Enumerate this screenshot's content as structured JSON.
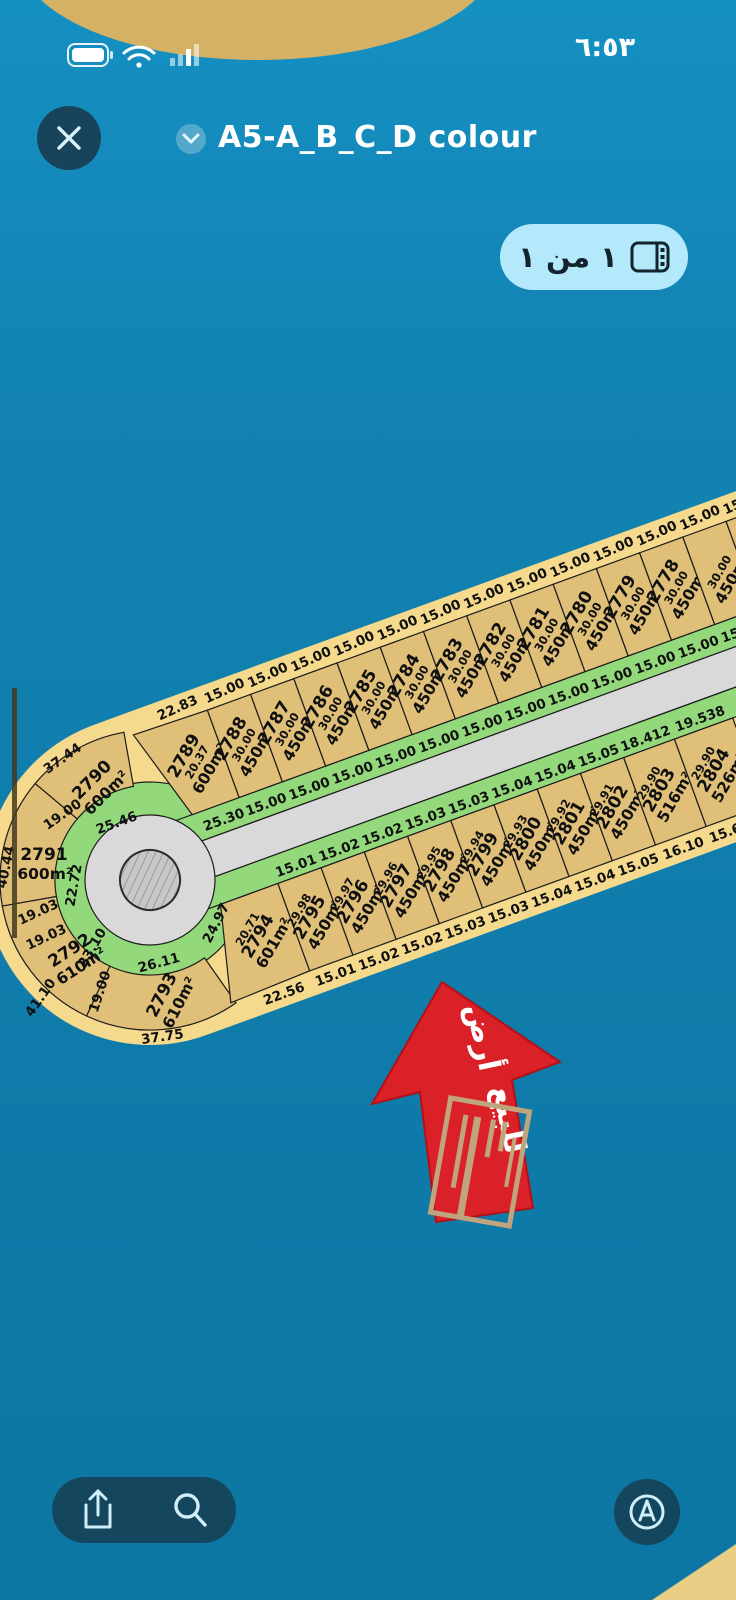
{
  "status_bar": {
    "time": "٦:٥٣",
    "battery_icon": "battery-full",
    "wifi_icon": "wifi",
    "cellular_icon": "cellular-bars"
  },
  "header": {
    "title": "A5-A_B_C_D colour"
  },
  "page_badge": {
    "label": "١ من ١"
  },
  "map": {
    "colors": {
      "sea": "#0f7cab",
      "island": "#f5da8e",
      "plot_fill": "#e0bf78",
      "green_strip": "#93d97c",
      "road": "#d9d9d9",
      "arrow_red": "#da2127",
      "line": "#1c1c1c"
    },
    "north_cells": [
      {
        "num": "2789",
        "area": "600m²",
        "side": "20.37"
      },
      {
        "num": "2788",
        "area": "450m²",
        "side": "30.00"
      },
      {
        "num": "2787",
        "area": "450m²",
        "side": "30.00"
      },
      {
        "num": "2786",
        "area": "450m²",
        "side": "30.00"
      },
      {
        "num": "2785",
        "area": "450m²",
        "side": "30.00"
      },
      {
        "num": "2784",
        "area": "450m²",
        "side": "30.00"
      },
      {
        "num": "2783",
        "area": "450m²",
        "side": "30.00"
      },
      {
        "num": "2782",
        "area": "450m²",
        "side": "30.00"
      },
      {
        "num": "2781",
        "area": "450m²",
        "side": "30.00"
      },
      {
        "num": "2780",
        "area": "450m²",
        "side": "30.00"
      },
      {
        "num": "2779",
        "area": "450m²",
        "side": "30.00"
      },
      {
        "num": "2778",
        "area": "450m²",
        "side": "30.00"
      },
      {
        "num": "",
        "area": "450m²",
        "side": "30.00"
      }
    ],
    "south_cells": [
      {
        "num": "2794",
        "area": "601m²",
        "side": "20.71"
      },
      {
        "num": "2795",
        "area": "450m²",
        "side": "29.98"
      },
      {
        "num": "2796",
        "area": "450m²",
        "side": "29.97"
      },
      {
        "num": "2797",
        "area": "450m²",
        "side": "29.96"
      },
      {
        "num": "2798",
        "area": "450m²",
        "side": "29.95"
      },
      {
        "num": "2799",
        "area": "450m²",
        "side": "29.94"
      },
      {
        "num": "2800",
        "area": "450m²",
        "side": "29.93"
      },
      {
        "num": "2801",
        "area": "450m²",
        "side": "29.92"
      },
      {
        "num": "2802",
        "area": "450m²",
        "side": "29.91"
      },
      {
        "num": "2803",
        "area": "516m²",
        "side": "29.90"
      },
      {
        "num": "2804",
        "area": "526m²",
        "side": "29.90"
      }
    ],
    "bulb_plots": [
      {
        "num": "2790",
        "area": "600m²"
      },
      {
        "num": "2791",
        "area": "600m²"
      },
      {
        "num": "2792",
        "area": "610m²"
      },
      {
        "num": "2793",
        "area": "610m²"
      }
    ],
    "north_top_labels": [
      "22.83",
      "15.00",
      "15.00",
      "15.00",
      "15.00",
      "15.00",
      "15.00",
      "15.00",
      "15.00",
      "15.00",
      "15.00",
      "15.00",
      "15.00",
      "15.00"
    ],
    "north_green_labels": [
      "25.30",
      "15.00",
      "15.00",
      "15.00",
      "15.00",
      "15.00",
      "15.00",
      "15.00",
      "15.00",
      "15.00",
      "15.00",
      "15.00",
      "15.00"
    ],
    "south_green_labels": [
      "15.01",
      "15.02",
      "15.02",
      "15.03",
      "15.03",
      "15.04",
      "15.04",
      "15.05",
      "18.412",
      "19.538"
    ],
    "south_bottom_labels": [
      "22.56",
      "15.01",
      "15.02",
      "15.02",
      "15.03",
      "15.03",
      "15.04",
      "15.04",
      "15.05",
      "16.10",
      "15.645"
    ],
    "bulb_dim_labels": [
      "37.44",
      "25.46",
      "19.00",
      "40.44",
      "22.72",
      "19.03",
      "19.03",
      "23.10",
      "41.10",
      "19.00",
      "26.11",
      "37.75",
      "24.97"
    ],
    "arrow": {
      "word1": "أرض",
      "word2": "للبيع"
    }
  },
  "toolbar": {
    "share_icon": "share",
    "search_icon": "search",
    "compass_icon": "navigate"
  }
}
